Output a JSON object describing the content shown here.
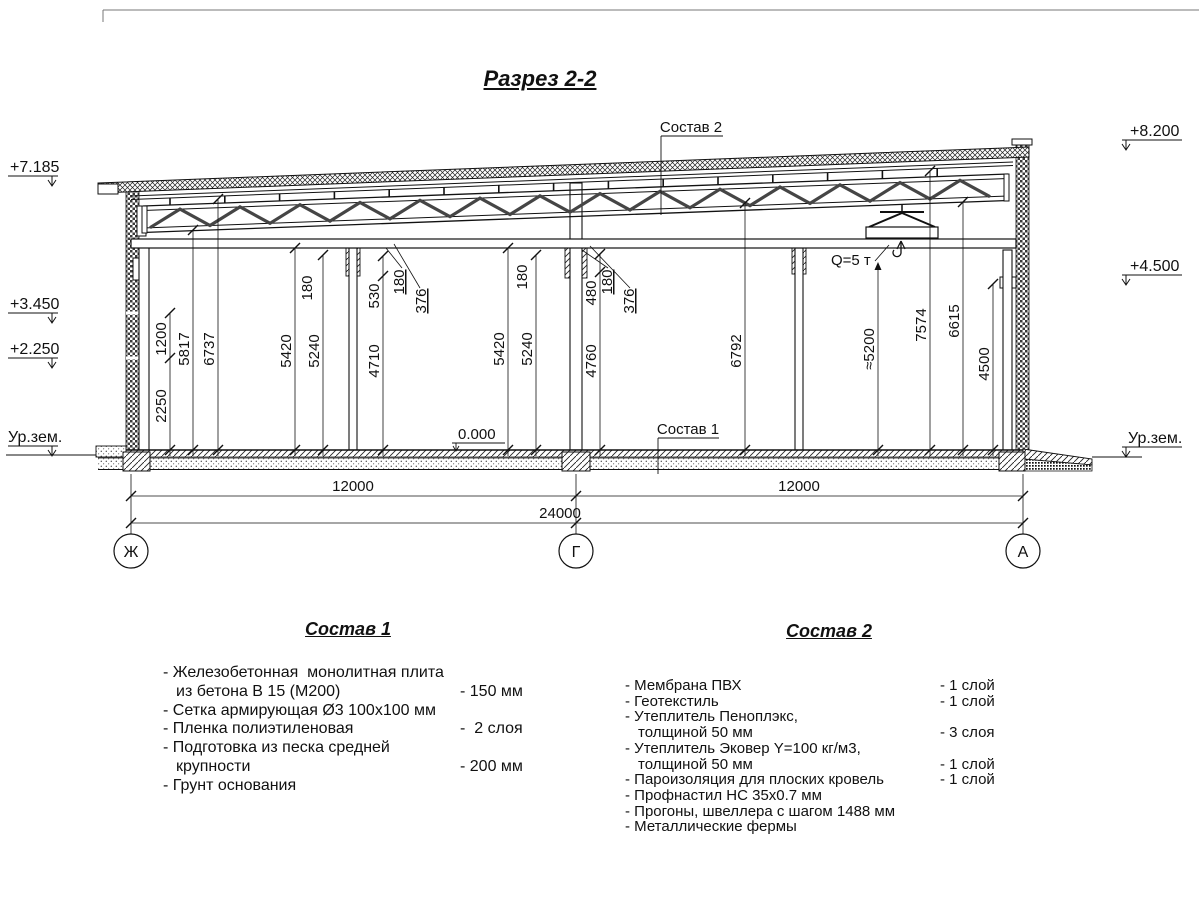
{
  "title": "Разрез 2-2",
  "levels": {
    "left": [
      "+7.185",
      "+3.450",
      "+2.250",
      "Ур.зем."
    ],
    "right": [
      "+8.200",
      "+4.500",
      "Ур.зем."
    ]
  },
  "callouts": {
    "composition2": "Состав 2",
    "composition1": "Состав 1",
    "zero_level": "0.000",
    "crane_capacity": "Q=5 т"
  },
  "vdims": [
    "2250",
    "1200",
    "5817",
    "6737",
    "5420",
    "5240",
    "180",
    "4710",
    "530",
    "180",
    "376",
    "5420",
    "5240",
    "180",
    "480",
    "4760",
    "180",
    "376",
    "6792",
    "≈5200",
    "7574",
    "6615",
    "4500"
  ],
  "hdims": [
    "12000",
    "12000",
    "24000"
  ],
  "axes": [
    "Ж",
    "Г",
    "А"
  ],
  "lists": {
    "sostav1": {
      "title": "Состав 1",
      "rows": [
        {
          "t": "- Железобетонная  монолитная плита",
          "v": ""
        },
        {
          "t": "из бетона В 15 (М200)",
          "v": "- 150 мм"
        },
        {
          "t": "- Сетка армирующая Ø3 100х100 мм",
          "v": ""
        },
        {
          "t": "- Пленка полиэтиленовая",
          "v": "-  2 слоя"
        },
        {
          "t": "- Подготовка из песка средней",
          "v": ""
        },
        {
          "t": "крупности",
          "v": "- 200 мм"
        },
        {
          "t": "- Грунт основания",
          "v": ""
        }
      ]
    },
    "sostav2": {
      "title": "Состав 2",
      "rows": [
        {
          "t": "- Мембрана ПВХ",
          "v": "- 1 слой"
        },
        {
          "t": "- Геотекстиль",
          "v": "- 1 слой"
        },
        {
          "t": "- Утеплитель Пеноплэкс,",
          "v": ""
        },
        {
          "t": "толщиной 50 мм",
          "v": "- 3 слоя"
        },
        {
          "t": "- Утеплитель Эковер Y=100 кг/м3,",
          "v": ""
        },
        {
          "t": "толщиной 50 мм",
          "v": "- 1 слой"
        },
        {
          "t": "- Пароизоляция для плоских кровель",
          "v": "- 1 слой"
        },
        {
          "t": "- Профнастил НС 35х0.7 мм",
          "v": ""
        },
        {
          "t": "- Прогоны, швеллера с шагом 1488 мм",
          "v": ""
        },
        {
          "t": "- Металлические фермы",
          "v": ""
        }
      ]
    }
  }
}
